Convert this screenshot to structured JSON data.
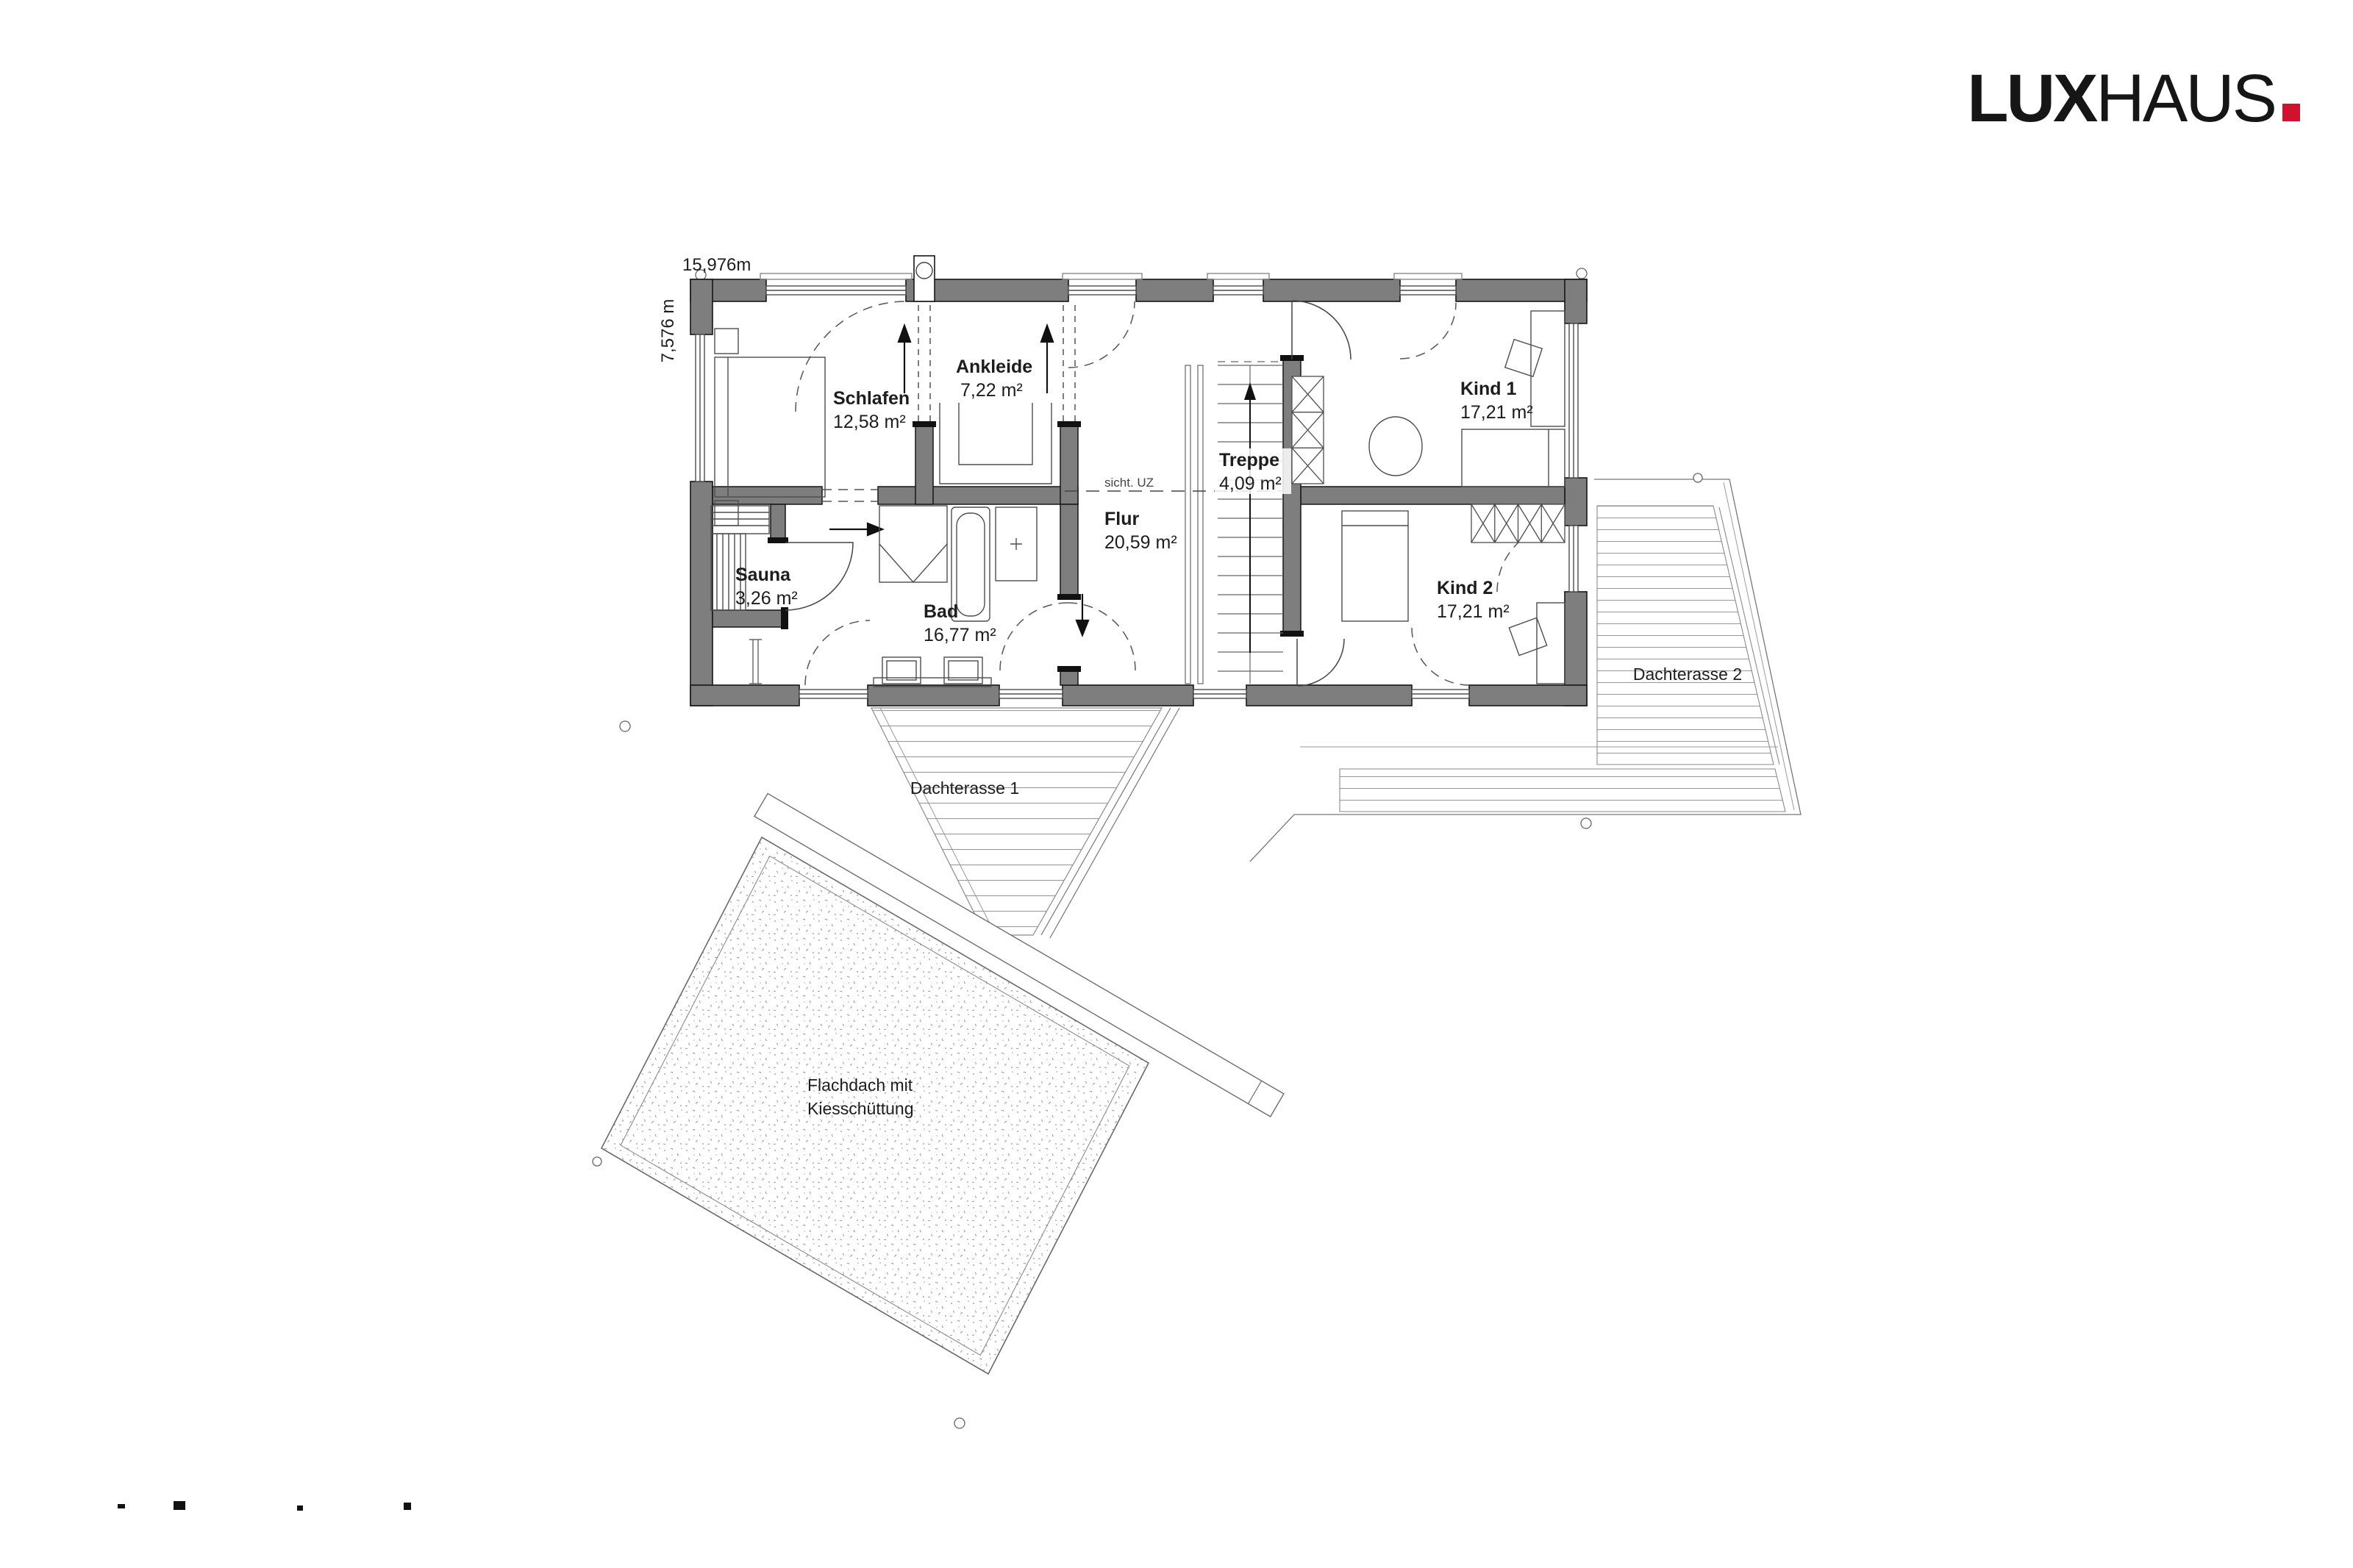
{
  "logo": {
    "lux": "LUX",
    "haus": "HAUS",
    "dot_color": "#d0122f"
  },
  "dimensions": {
    "width_label": "15,976m",
    "height_label": "7,576 m"
  },
  "rooms": [
    {
      "id": "schlafen",
      "name": "Schlafen",
      "area": "12,58 m²"
    },
    {
      "id": "ankleide",
      "name": "Ankleide",
      "area": "7,22 m²"
    },
    {
      "id": "treppe",
      "name": "Treppe",
      "area": "4,09 m²"
    },
    {
      "id": "flur",
      "name": "Flur",
      "area": "20,59 m²"
    },
    {
      "id": "kind1",
      "name": "Kind 1",
      "area": "17,21 m²"
    },
    {
      "id": "kind2",
      "name": "Kind 2",
      "area": "17,21 m²"
    },
    {
      "id": "sauna",
      "name": "Sauna",
      "area": "3,26 m²"
    },
    {
      "id": "bad",
      "name": "Bad",
      "area": "16,77 m²"
    }
  ],
  "outdoor": {
    "terrace1": "Dachterasse 1",
    "terrace2": "Dachterasse 2",
    "flat_roof_line1": "Flachdach mit",
    "flat_roof_line2": "Kiesschüttung"
  },
  "annotations": {
    "beam": "sicht. UZ"
  },
  "colors": {
    "wall_fill": "#7e7e7e",
    "wall_stroke": "#161616",
    "logo_red": "#d0122f"
  }
}
